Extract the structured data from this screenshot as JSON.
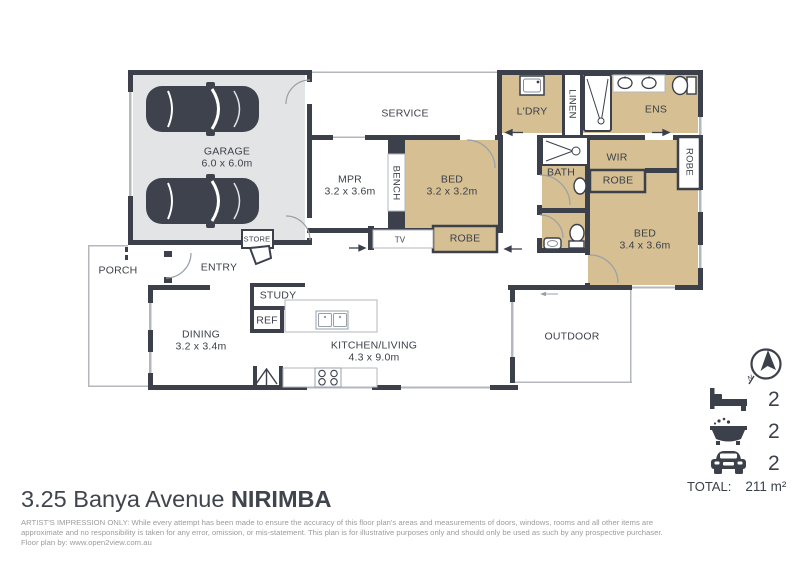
{
  "plan": {
    "rooms": {
      "garage": {
        "name": "GARAGE",
        "dims": "6.0 x 6.0m"
      },
      "service": {
        "name": "SERVICE"
      },
      "mpr": {
        "name": "MPR",
        "dims": "3.2 x 3.6m"
      },
      "bench": {
        "name": "BENCH"
      },
      "bed1": {
        "name": "BED",
        "dims": "3.2 x 3.2m"
      },
      "tv": {
        "name": "TV"
      },
      "robe_bed1": {
        "name": "ROBE"
      },
      "ldry": {
        "name": "L'DRY"
      },
      "linen": {
        "name": "LINEN"
      },
      "ens": {
        "name": "ENS"
      },
      "bath": {
        "name": "BATH"
      },
      "wir": {
        "name": "WIR"
      },
      "robe_wir": {
        "name": "ROBE"
      },
      "robe_right": {
        "name": "ROBE"
      },
      "bed2": {
        "name": "BED",
        "dims": "3.4 x 3.6m"
      },
      "store": {
        "name": "STORE"
      },
      "porch": {
        "name": "PORCH"
      },
      "entry": {
        "name": "ENTRY"
      },
      "study": {
        "name": "STUDY"
      },
      "ref": {
        "name": "REF"
      },
      "dining": {
        "name": "DINING",
        "dims": "3.2 x 3.4m"
      },
      "kitchen_living": {
        "name": "KITCHEN/LIVING",
        "dims": "4.3 x 9.0m"
      },
      "outdoor": {
        "name": "OUTDOOR"
      }
    },
    "compass": {
      "label": "N"
    },
    "legend": {
      "bedrooms": "2",
      "bathrooms": "2",
      "car_spaces": "2",
      "total_label": "TOTAL:",
      "total_value": "211 m²"
    },
    "footer": {
      "address": "3.25 Banya Avenue",
      "suburb": "NIRIMBA",
      "disclaimer_line1": "ARTIST'S IMPRESSION ONLY: While every attempt has been made to ensure the accuracy of this floor plan's areas and measurements of doors, windows, rooms and all other items are",
      "disclaimer_line2": "approximate and no responsibility is taken for any error, omission, or mis-statement. This plan is for illustrative purposes only and should only be used as such by any prospective purchaser.",
      "credit": "Floor plan by: www.open2view.com.au"
    },
    "colors": {
      "wall": "#3b404b",
      "room_tan": "#d5bf93",
      "garage_gray": "#e3e4e6"
    }
  }
}
